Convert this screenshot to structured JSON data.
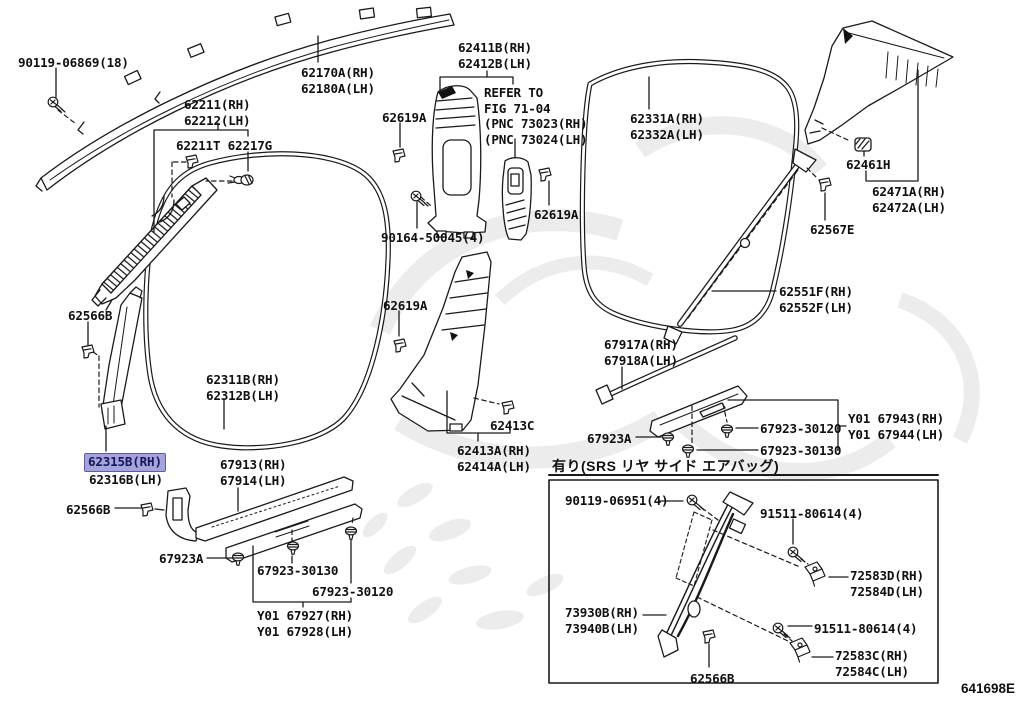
{
  "diagram": {
    "code": "641698E",
    "srs_note": "有り(SRS リヤ サイド エアバッグ)",
    "highlight": {
      "bg": "#a5a4d9",
      "border": "#5b5ab2",
      "text": "#16165e"
    },
    "line_color": "#1a1a1a",
    "labels": [
      {
        "id": "90119-06869",
        "x": 18,
        "y": 55,
        "lines": [
          "90119-06869(18)"
        ]
      },
      {
        "id": "62170A",
        "x": 301,
        "y": 65,
        "lines": [
          "62170A(RH)",
          "62180A(LH)"
        ]
      },
      {
        "id": "62211",
        "x": 184,
        "y": 97,
        "lines": [
          "62211(RH)",
          "62212(LH)"
        ]
      },
      {
        "id": "62211T-62217G",
        "x": 176,
        "y": 138,
        "lines": [
          "62211T 62217G"
        ]
      },
      {
        "id": "62619A-1",
        "x": 382,
        "y": 110,
        "lines": [
          "62619A"
        ]
      },
      {
        "id": "62411B",
        "x": 458,
        "y": 40,
        "lines": [
          "62411B(RH)",
          "62412B(LH)"
        ]
      },
      {
        "id": "refer-note",
        "x": 484,
        "y": 85,
        "lines": [
          "REFER TO",
          "FIG 71-04",
          "(PNC 73023(RH)",
          "(PNC 73024(LH)"
        ],
        "static": true
      },
      {
        "id": "62331A",
        "x": 630,
        "y": 111,
        "lines": [
          "62331A(RH)",
          "62332A(LH)"
        ]
      },
      {
        "id": "62461H",
        "x": 846,
        "y": 157,
        "lines": [
          "62461H"
        ]
      },
      {
        "id": "62471A",
        "x": 872,
        "y": 184,
        "lines": [
          "62471A(RH)",
          "62472A(LH)"
        ]
      },
      {
        "id": "62619A-2",
        "x": 534,
        "y": 207,
        "lines": [
          "62619A"
        ]
      },
      {
        "id": "90164-50045",
        "x": 381,
        "y": 230,
        "lines": [
          "90164-50045(4)"
        ]
      },
      {
        "id": "62567E",
        "x": 810,
        "y": 222,
        "lines": [
          "62567E"
        ]
      },
      {
        "id": "62619A-3",
        "x": 383,
        "y": 298,
        "lines": [
          "62619A"
        ]
      },
      {
        "id": "62551F",
        "x": 779,
        "y": 284,
        "lines": [
          "62551F(RH)",
          "62552F(LH)"
        ]
      },
      {
        "id": "62566B-1",
        "x": 68,
        "y": 308,
        "lines": [
          "62566B"
        ]
      },
      {
        "id": "67917A",
        "x": 604,
        "y": 337,
        "lines": [
          "67917A(RH)",
          "67918A(LH)"
        ]
      },
      {
        "id": "62311B",
        "x": 206,
        "y": 372,
        "lines": [
          "62311B(RH)",
          "62312B(LH)"
        ]
      },
      {
        "id": "62315B",
        "x": 89,
        "y": 454,
        "lines": [
          "62315B(RH)",
          "62316B(LH)"
        ],
        "highlight_line": 0
      },
      {
        "id": "62413C",
        "x": 490,
        "y": 418,
        "lines": [
          "62413C"
        ]
      },
      {
        "id": "62413A",
        "x": 457,
        "y": 443,
        "lines": [
          "62413A(RH)",
          "62414A(LH)"
        ]
      },
      {
        "id": "67923A-1",
        "x": 587,
        "y": 431,
        "lines": [
          "67923A"
        ]
      },
      {
        "id": "67923-30120-1",
        "x": 760,
        "y": 421,
        "lines": [
          "67923-30120"
        ]
      },
      {
        "id": "67923-30130-1",
        "x": 760,
        "y": 443,
        "lines": [
          "67923-30130"
        ]
      },
      {
        "id": "Y01-67943",
        "x": 848,
        "y": 411,
        "lines": [
          "Y01 67943(RH)",
          "Y01 67944(LH)"
        ]
      },
      {
        "id": "67913",
        "x": 220,
        "y": 457,
        "lines": [
          "67913(RH)",
          "67914(LH)"
        ]
      },
      {
        "id": "62566B-2",
        "x": 66,
        "y": 502,
        "lines": [
          "62566B"
        ]
      },
      {
        "id": "67923A-2",
        "x": 159,
        "y": 551,
        "lines": [
          "67923A"
        ]
      },
      {
        "id": "67923-30130-2",
        "x": 257,
        "y": 563,
        "lines": [
          "67923-30130"
        ]
      },
      {
        "id": "67923-30120-2",
        "x": 312,
        "y": 584,
        "lines": [
          "67923-30120"
        ]
      },
      {
        "id": "Y01-67927",
        "x": 257,
        "y": 608,
        "lines": [
          "Y01 67927(RH)",
          "Y01 67928(LH)"
        ]
      },
      {
        "id": "90119-06951",
        "x": 565,
        "y": 493,
        "lines": [
          "90119-06951(4)"
        ]
      },
      {
        "id": "91511-80614-1",
        "x": 760,
        "y": 506,
        "lines": [
          "91511-80614(4)"
        ]
      },
      {
        "id": "72583D",
        "x": 850,
        "y": 568,
        "lines": [
          "72583D(RH)",
          "72584D(LH)"
        ]
      },
      {
        "id": "73930B",
        "x": 565,
        "y": 605,
        "lines": [
          "73930B(RH)",
          "73940B(LH)"
        ]
      },
      {
        "id": "91511-80614-2",
        "x": 814,
        "y": 621,
        "lines": [
          "91511-80614(4)"
        ]
      },
      {
        "id": "72583C",
        "x": 835,
        "y": 648,
        "lines": [
          "72583C(RH)",
          "72584C(LH)"
        ]
      },
      {
        "id": "62566B-3",
        "x": 690,
        "y": 671,
        "lines": [
          "62566B"
        ]
      }
    ]
  }
}
